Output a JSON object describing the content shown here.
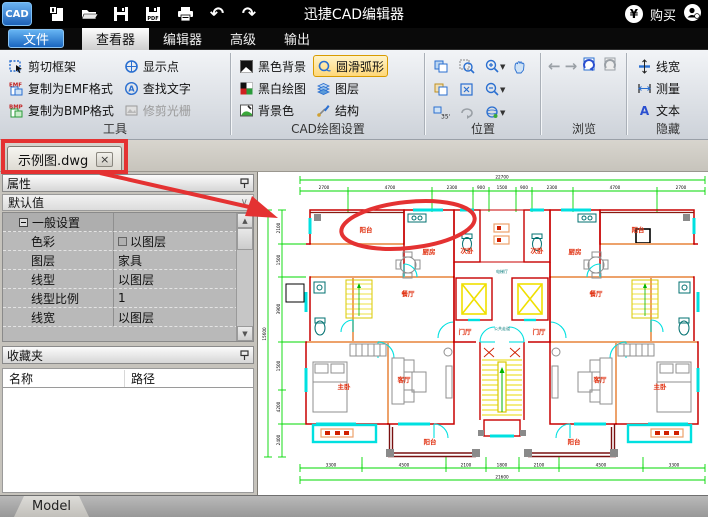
{
  "titlebar": {
    "app": "CAD",
    "title": "迅捷CAD编辑器",
    "buy": "购买",
    "pdf_badge": "PDF"
  },
  "glyphs": {
    "undo": "↶",
    "redo": "↷",
    "back": "←",
    "forward": "→",
    "currency": "¥",
    "chevron": "∨",
    "up": "▲",
    "down": "▼",
    "close": "×",
    "a": "A",
    "rotate35": "35°"
  },
  "menu": {
    "file": "文件",
    "viewer": "查看器",
    "editor": "编辑器",
    "advanced": "高级",
    "output": "输出"
  },
  "ribbon": {
    "tools": {
      "label": "工具",
      "clip": "剪切框架",
      "emf": "复制为EMF格式",
      "bmp": "复制为BMP格式",
      "points": "显示点",
      "find": "查找文字",
      "raster": "修剪光栅",
      "emf_badge": "EMF",
      "bmp_badge": "BMP"
    },
    "cad": {
      "label": "CAD绘图设置",
      "black_bg": "黑色背景",
      "bw": "黑白绘图",
      "bg_color": "背景色",
      "arc": "圆滑弧形",
      "layers": "图层",
      "structure": "结构"
    },
    "position": {
      "label": "位置"
    },
    "browse": {
      "label": "浏览"
    },
    "hide": {
      "label": "隐藏",
      "linewidth": "线宽",
      "measure": "测量",
      "text": "文本"
    }
  },
  "doc_tab": {
    "name": "示例图.dwg"
  },
  "properties": {
    "title": "属性",
    "preset": "默认值",
    "group": "一般设置",
    "rows": [
      {
        "label": "色彩",
        "value": "以图层"
      },
      {
        "label": "图层",
        "value": "家具"
      },
      {
        "label": "线型",
        "value": "以图层"
      },
      {
        "label": "线型比例",
        "value": "1"
      },
      {
        "label": "线宽",
        "value": "以图层"
      }
    ]
  },
  "favorites": {
    "title": "收藏夹",
    "col_name": "名称",
    "col_path": "路径"
  },
  "statusbar": {
    "model": "Model"
  },
  "drawing": {
    "labels": {
      "balcony_tl": "阳台",
      "kitchen_l": "厨房",
      "bed2_l": "次卧",
      "dining_l": "餐厅",
      "master_l": "主卧",
      "living_l": "客厅",
      "balcony_bl": "阳台",
      "hall_l": "门厅",
      "balcony_tr": "阳台",
      "kitchen_r": "厨房",
      "bed2_r": "次卧",
      "dining_r": "餐厅",
      "master_r": "主卧",
      "living_r": "客厅",
      "balcony_br": "阳台",
      "hall_r": "门厅",
      "core_top": "电梯厅",
      "core_mid": "公共走道"
    },
    "dims_top": [
      "2700",
      "4700",
      "2300",
      "900",
      "1500",
      "900",
      "2300",
      "4700",
      "2700"
    ],
    "dims_top_overall": "22700",
    "dims_bottom": [
      "3300",
      "4500",
      "2100",
      "1800",
      "2100",
      "4500",
      "3300"
    ],
    "dims_bottom_overall": "21600",
    "dims_left": [
      "2100",
      "1500",
      "3900",
      "1500",
      "4200",
      "2400"
    ],
    "dims_left_overall": "15600",
    "colors": {
      "wall": "#c80000",
      "window": "#00e0e0",
      "dim": "#00d800",
      "accent": "#f0e000",
      "annotation": "#e43232"
    }
  }
}
